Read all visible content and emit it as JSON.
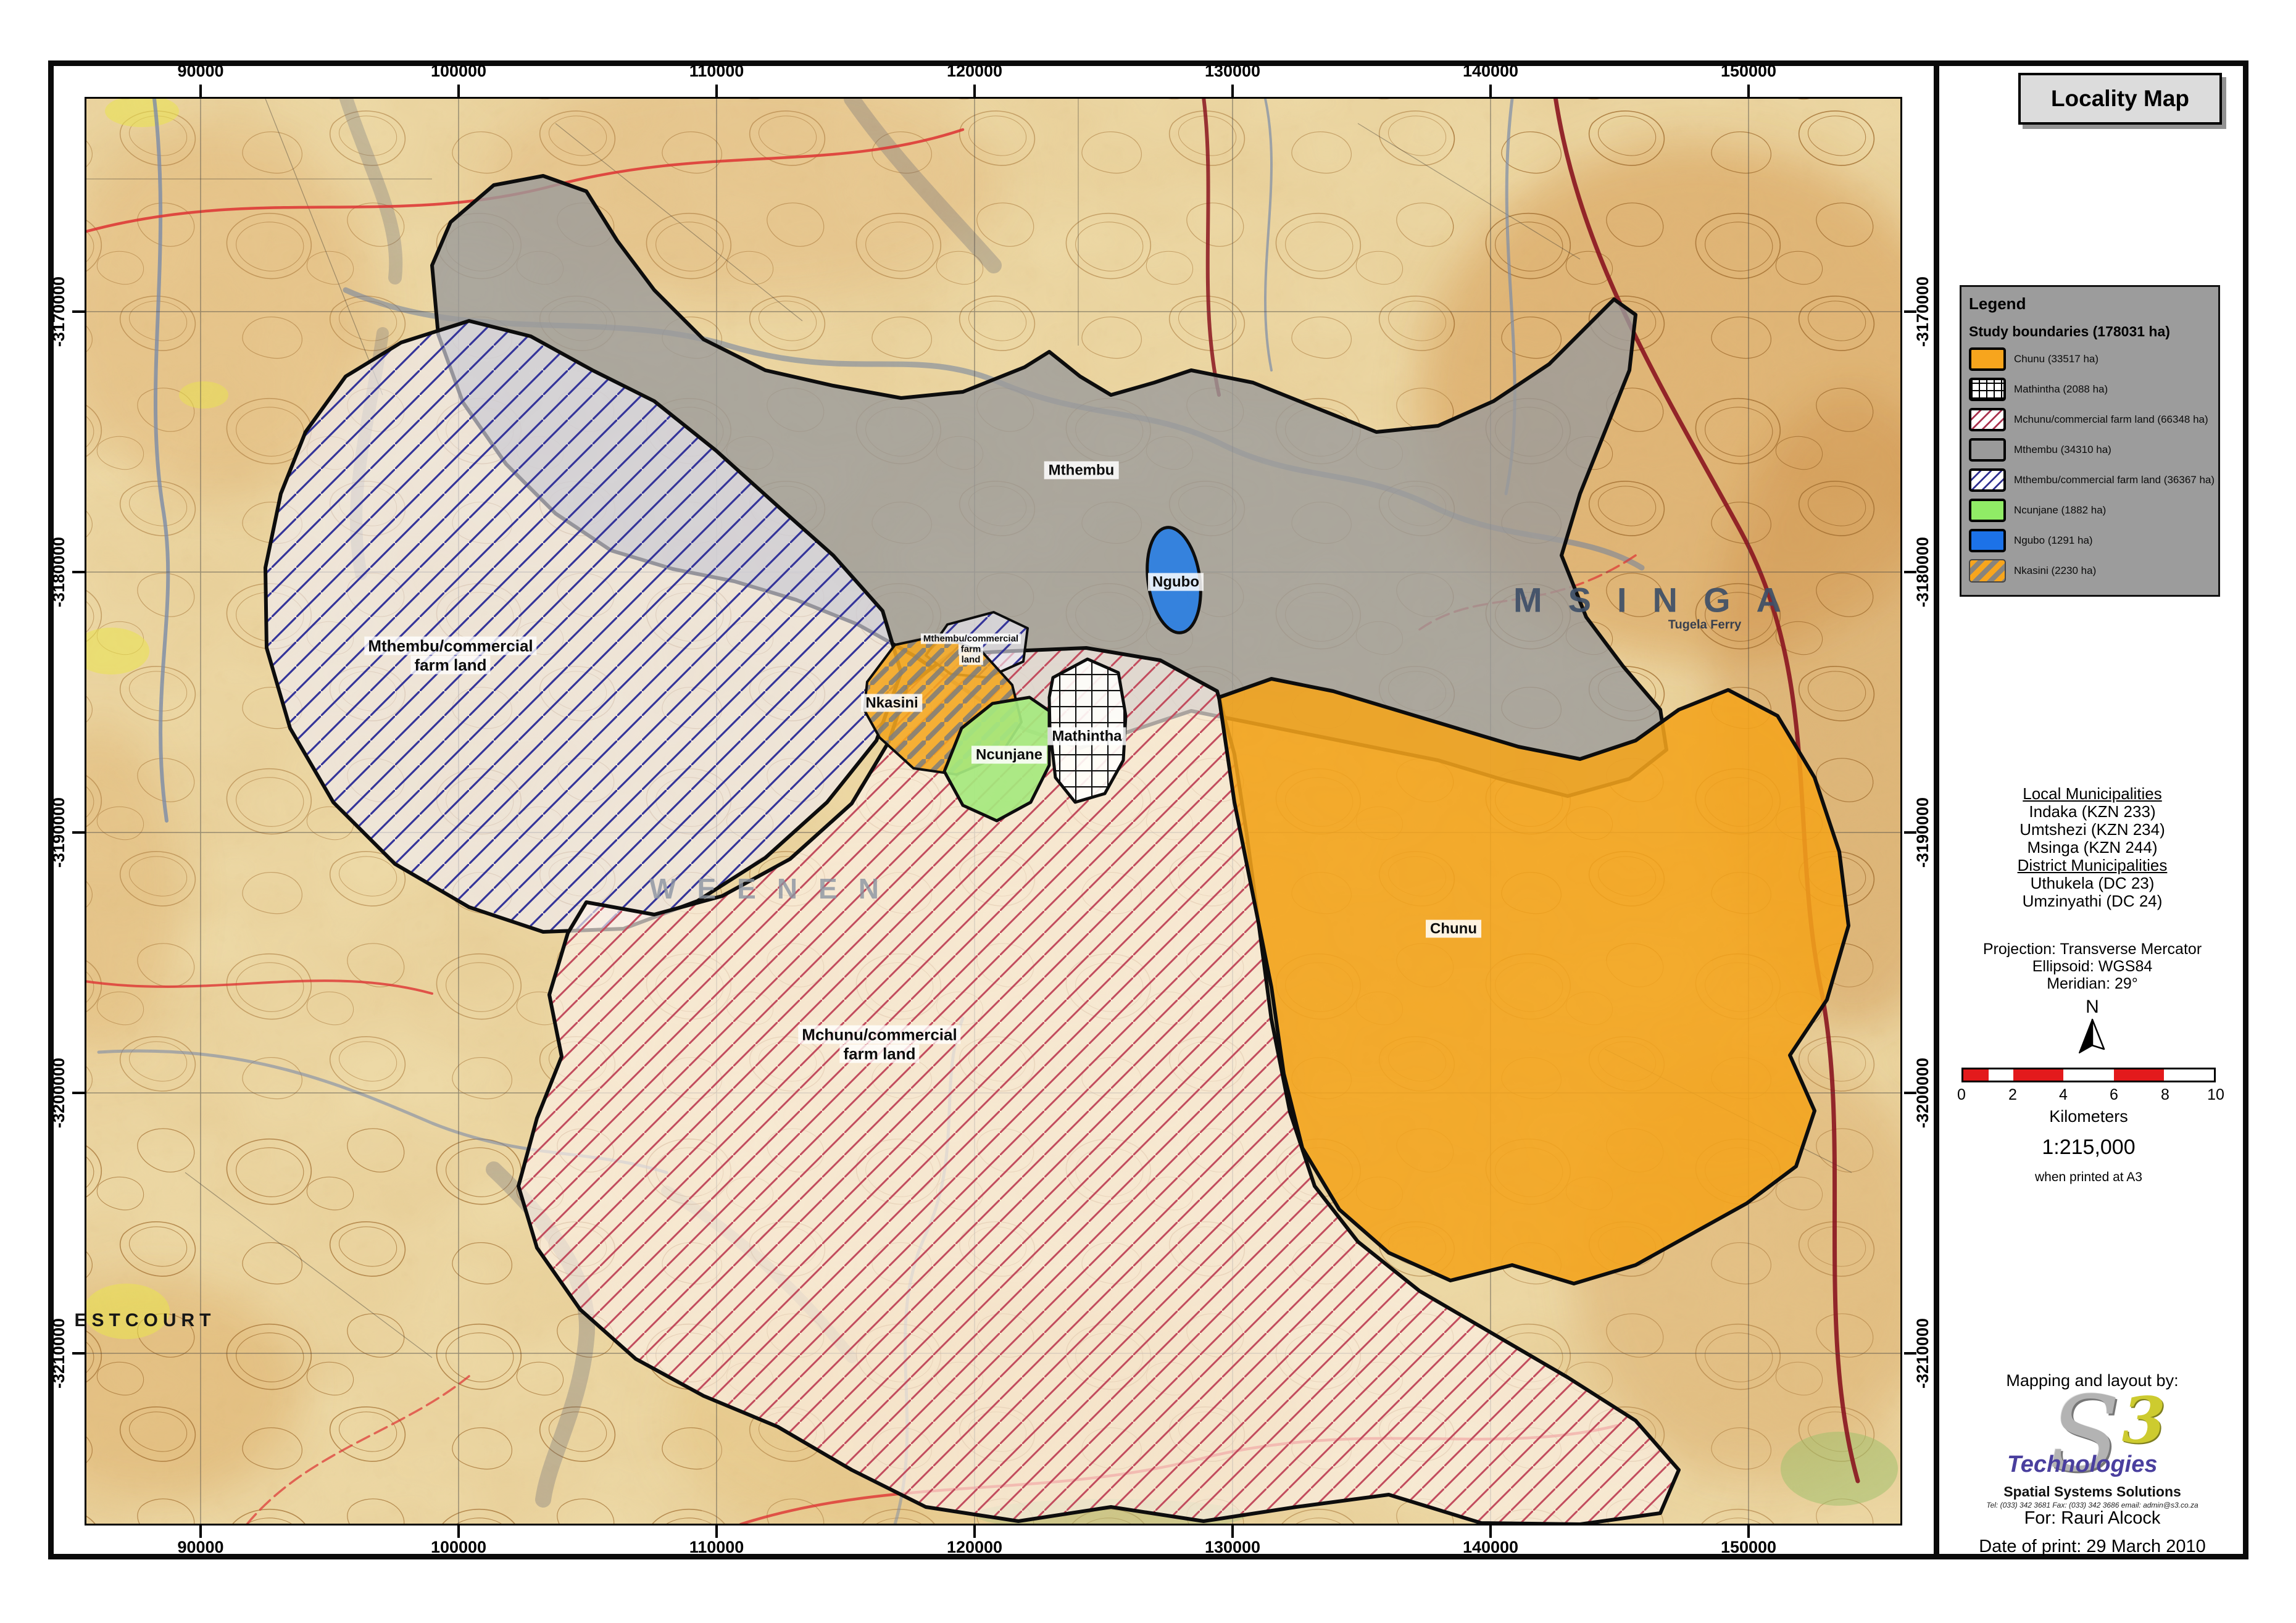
{
  "window": {
    "title_box": "Locality Map"
  },
  "map": {
    "x_ticks": [
      "90000",
      "100000",
      "110000",
      "120000",
      "130000",
      "140000",
      "150000"
    ],
    "y_ticks": [
      "-3170000",
      "-3180000",
      "-3190000",
      "-3200000",
      "-3210000"
    ],
    "region_labels": [
      {
        "id": "mthembu-commercial-farm-land-label",
        "cls": "rl-big",
        "lines": [
          "Mthembu/commercial",
          "farm land"
        ]
      },
      {
        "id": "mthembu-label",
        "cls": "rl-chip",
        "lines": [
          "Mthembu"
        ]
      },
      {
        "id": "ngubo-label",
        "cls": "rl-chip",
        "lines": [
          "Ngubo"
        ]
      },
      {
        "id": "mthembu-cfl-small-label",
        "cls": "rl-small",
        "lines": [
          "Mthembu/commercial",
          "farm",
          "land"
        ]
      },
      {
        "id": "nkasini-label",
        "cls": "rl-chip",
        "lines": [
          "Nkasini"
        ]
      },
      {
        "id": "ncunjane-label",
        "cls": "rl-chip",
        "lines": [
          "Ncunjane"
        ]
      },
      {
        "id": "mathintha-label",
        "cls": "rl-chip",
        "lines": [
          "Mathintha"
        ]
      },
      {
        "id": "chunu-label",
        "cls": "rl-chip",
        "lines": [
          "Chunu"
        ]
      },
      {
        "id": "mchunu-commercial-farm-land-label",
        "cls": "rl-big",
        "lines": [
          "Mchunu/commercial",
          "farm land"
        ]
      },
      {
        "id": "msinga-label",
        "cls": "rl-msinga",
        "lines": [
          "MSINGA"
        ]
      },
      {
        "id": "weenen-label",
        "cls": "rl-weenen",
        "lines": [
          "WEENEN"
        ]
      },
      {
        "id": "estcourt-label",
        "cls": "rl-estcourt",
        "lines": [
          "ESTCOURT"
        ]
      },
      {
        "id": "tugela-ferry-label",
        "cls": "rl-topo",
        "lines": [
          "Tugela Ferry"
        ]
      }
    ]
  },
  "legend": {
    "title": "Legend",
    "subtitle": "Study boundaries (178031 ha)",
    "items": [
      {
        "label": "Chunu (33517 ha)",
        "swatch": "chunu",
        "color": "#F7A51D"
      },
      {
        "label": "Mathintha (2088 ha)",
        "swatch": "mathintha",
        "color": "#FFFFFF"
      },
      {
        "label": "Mchunu/commercial farm land (66348 ha)",
        "swatch": "mchunu",
        "color": "#A8324E"
      },
      {
        "label": "Mthembu (34310 ha)",
        "swatch": "mthembu",
        "color": "#9A9A9A"
      },
      {
        "label": "Mthembu/commercial farm land (36367 ha)",
        "swatch": "mthembu-cfl",
        "color": "#2F2F8F"
      },
      {
        "label": "Ncunjane (1882 ha)",
        "swatch": "ncunjane",
        "color": "#90EC66"
      },
      {
        "label": "Ngubo (1291 ha)",
        "swatch": "ngubo",
        "color": "#1C72E8"
      },
      {
        "label": "Nkasini (2230 ha)",
        "swatch": "nkasini",
        "color": "#F7A51D"
      }
    ]
  },
  "info": {
    "local_heading": "Local Municipalities",
    "local_items": [
      "Indaka (KZN 233)",
      "Umtshezi (KZN 234)",
      "Msinga (KZN 244)"
    ],
    "district_heading": "District Municipalities",
    "district_items": [
      "Uthukela (DC 23)",
      "Umzinyathi (DC 24)"
    ],
    "projection_lines": [
      "Projection: Transverse Mercator",
      "Ellipsoid: WGS84",
      "Meridian: 29°"
    ]
  },
  "north": {
    "label": "N"
  },
  "scalebar": {
    "numbers": [
      "0",
      "2",
      "4",
      "6",
      "8",
      "10"
    ],
    "units": "Kilometers",
    "ratio": "1:215,000",
    "note": "when printed at A3",
    "bar_red": "#E31A1C"
  },
  "credits": {
    "mapping_by": "Mapping and layout by:",
    "logo_s": "S",
    "logo_3": "3",
    "logo_word": "Technologies",
    "logo_tagline": "Spatial Systems Solutions",
    "logo_contact": "Tel: (033) 342 3681   Fax: (033) 342 3686   email: admin@s3.co.za",
    "for_line": "For: Rauri Alcock",
    "date_line": "Date of print: 29 March 2010"
  }
}
